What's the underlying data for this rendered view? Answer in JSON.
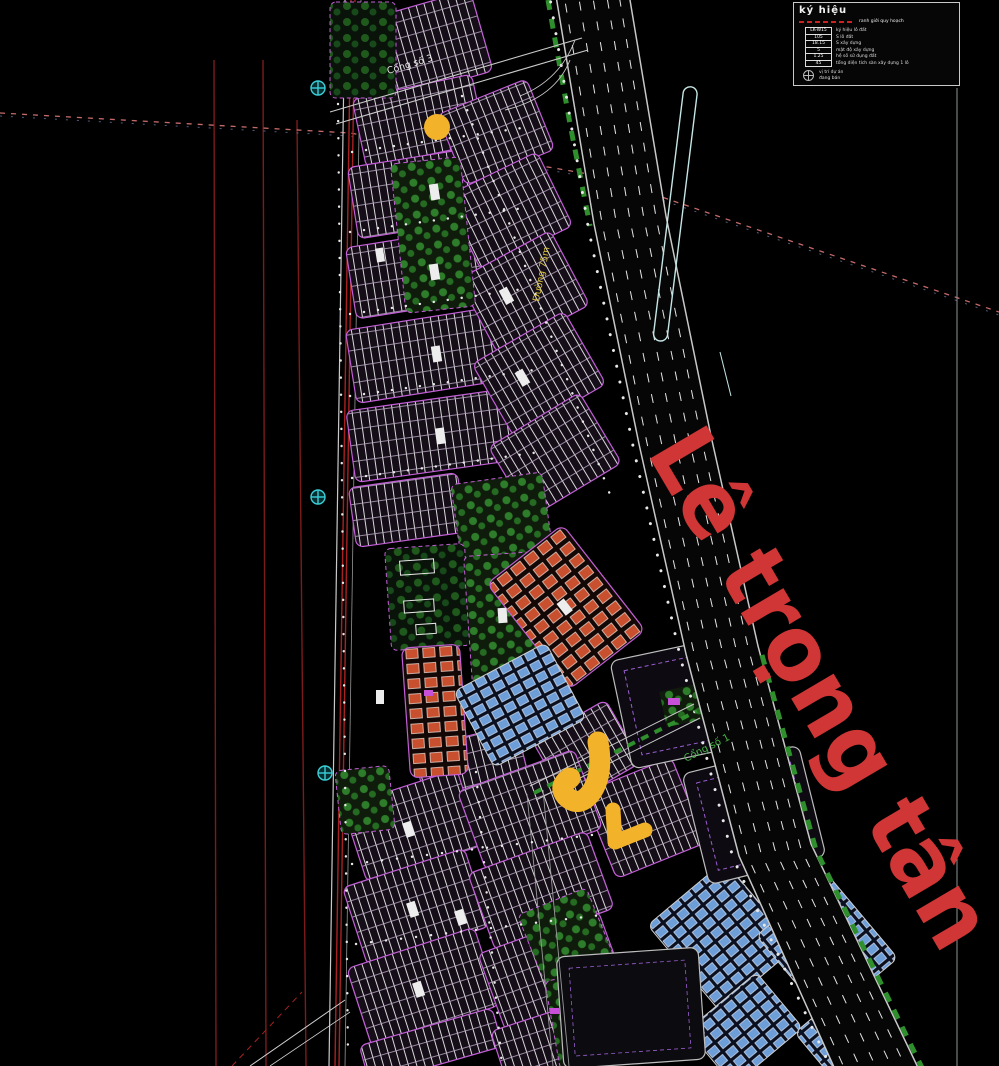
{
  "colors": {
    "background": "#000000",
    "road_name": "#d03636",
    "annotation": "#f2b32a",
    "parcel_red": "#a92222",
    "block_outline": "#c25fd6",
    "roof_orange": "#c8502f",
    "roof_blue": "#6e9ed8",
    "park_green": "#2e7d2a",
    "gate_cyan": "#39d0d8"
  },
  "legend": {
    "title": "ký hiệu",
    "boundary_sample_label": "ranh giới quy hoạch",
    "rows": [
      {
        "code": "LK-W15",
        "label": "ký hiệu lô đất"
      },
      {
        "code": "105",
        "label": "S lô đất"
      },
      {
        "code": "18.15",
        "label": "S xây dựng"
      },
      {
        "code": "5",
        "label": "mật độ xây dựng"
      },
      {
        "code": "1.25",
        "label": "hệ số sử dụng đất"
      },
      {
        "code": "45",
        "label": "tổng diện tích sàn xây dựng 1 lô"
      }
    ],
    "marker": {
      "line1": "vị trí dự án",
      "line2": "đang bán"
    }
  },
  "map_labels": {
    "main_road": "Lê trọng tân",
    "gate_top": "Cổng số 3",
    "gate_mid": "Cổng số 1",
    "road_width": "Đường 75m"
  },
  "annotations": {
    "marker_color": "#f2b32a",
    "items": [
      "highlight-circle",
      "highlight-arrow-large",
      "highlight-arrow-small"
    ]
  }
}
